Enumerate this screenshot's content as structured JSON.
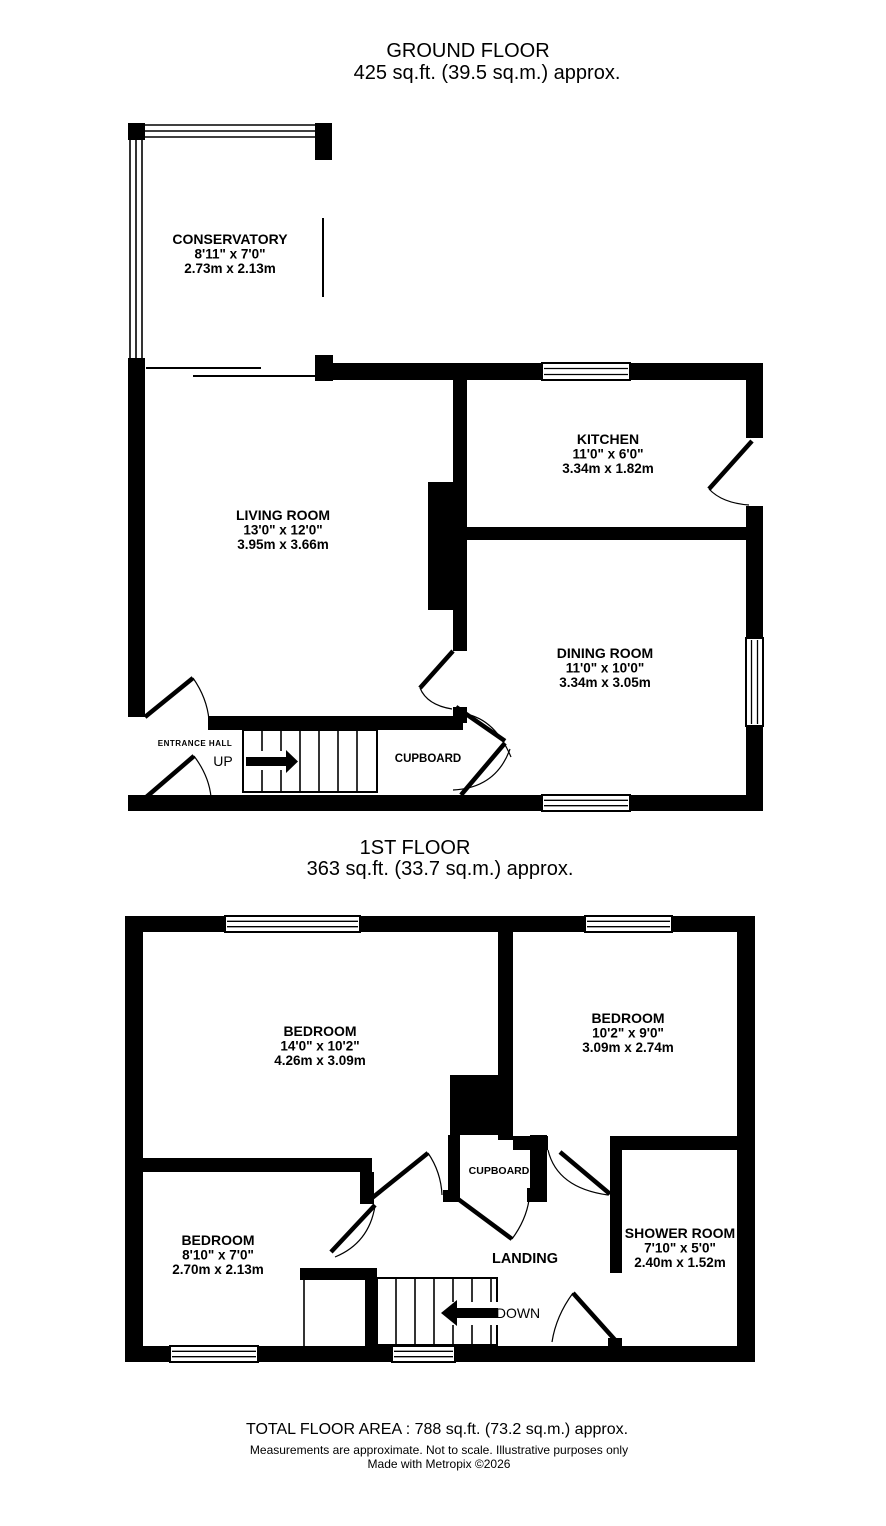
{
  "page": {
    "background": "#ffffff",
    "line_color": "#000000"
  },
  "ground_floor": {
    "title": "GROUND FLOOR",
    "subtitle": "425 sq.ft. (39.5 sq.m.) approx.",
    "rooms": {
      "conservatory": {
        "name": "CONSERVATORY",
        "imperial": "8'11\"  x 7'0\"",
        "metric": "2.73m  x 2.13m"
      },
      "living_room": {
        "name": "LIVING ROOM",
        "imperial": "13'0\"  x 12'0\"",
        "metric": "3.95m  x 3.66m"
      },
      "kitchen": {
        "name": "KITCHEN",
        "imperial": "11'0\"  x 6'0\"",
        "metric": "3.34m  x 1.82m"
      },
      "dining_room": {
        "name": "DINING ROOM",
        "imperial": "11'0\"  x 10'0\"",
        "metric": "3.34m  x 3.05m"
      }
    },
    "annotations": {
      "entrance_hall": "ENTRANCE HALL",
      "up": "UP",
      "cupboard": "CUPBOARD"
    }
  },
  "first_floor": {
    "title": "1ST FLOOR",
    "subtitle": "363 sq.ft. (33.7 sq.m.) approx.",
    "rooms": {
      "bedroom_main": {
        "name": "BEDROOM",
        "imperial": "14'0\"  x 10'2\"",
        "metric": "4.26m  x 3.09m"
      },
      "bedroom_rear": {
        "name": "BEDROOM",
        "imperial": "10'2\"  x 9'0\"",
        "metric": "3.09m  x 2.74m"
      },
      "bedroom_small": {
        "name": "BEDROOM",
        "imperial": "8'10\"  x 7'0\"",
        "metric": "2.70m  x 2.13m"
      },
      "shower_room": {
        "name": "SHOWER ROOM",
        "imperial": "7'10\"  x 5'0\"",
        "metric": "2.40m  x 1.52m"
      }
    },
    "annotations": {
      "landing": "LANDING",
      "down": "DOWN",
      "cupboard": "CUPBOARD"
    }
  },
  "footer": {
    "total": "TOTAL FLOOR AREA : 788 sq.ft. (73.2 sq.m.) approx.",
    "disclaimer": "Measurements are approximate.  Not to scale.  Illustrative purposes only",
    "credit": "Made with Metropix ©2026"
  }
}
